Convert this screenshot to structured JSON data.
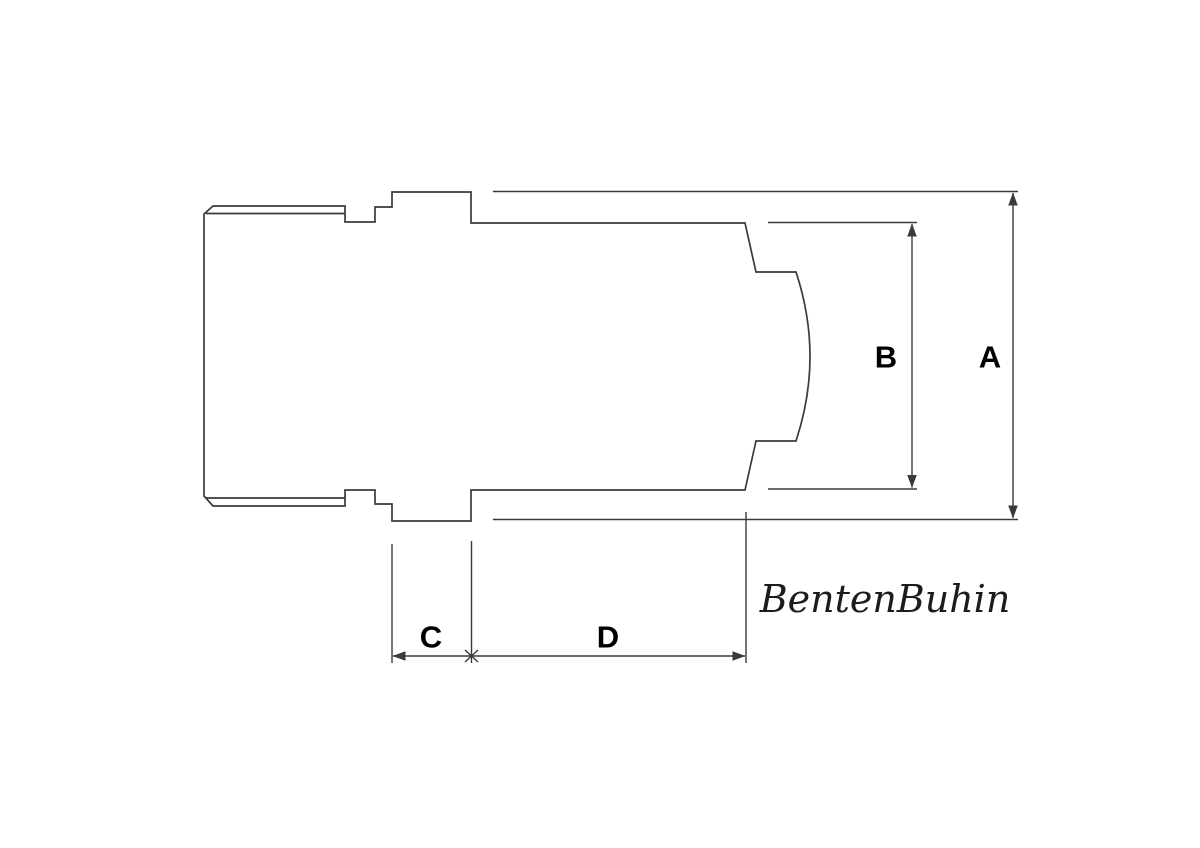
{
  "drawing": {
    "labels": {
      "a": "A",
      "b": "B",
      "c": "C",
      "d": "D"
    },
    "signature": "BentenBuhin",
    "colors": {
      "line": "#3a3a3a",
      "label": "#000000",
      "background": "#ffffff"
    }
  }
}
